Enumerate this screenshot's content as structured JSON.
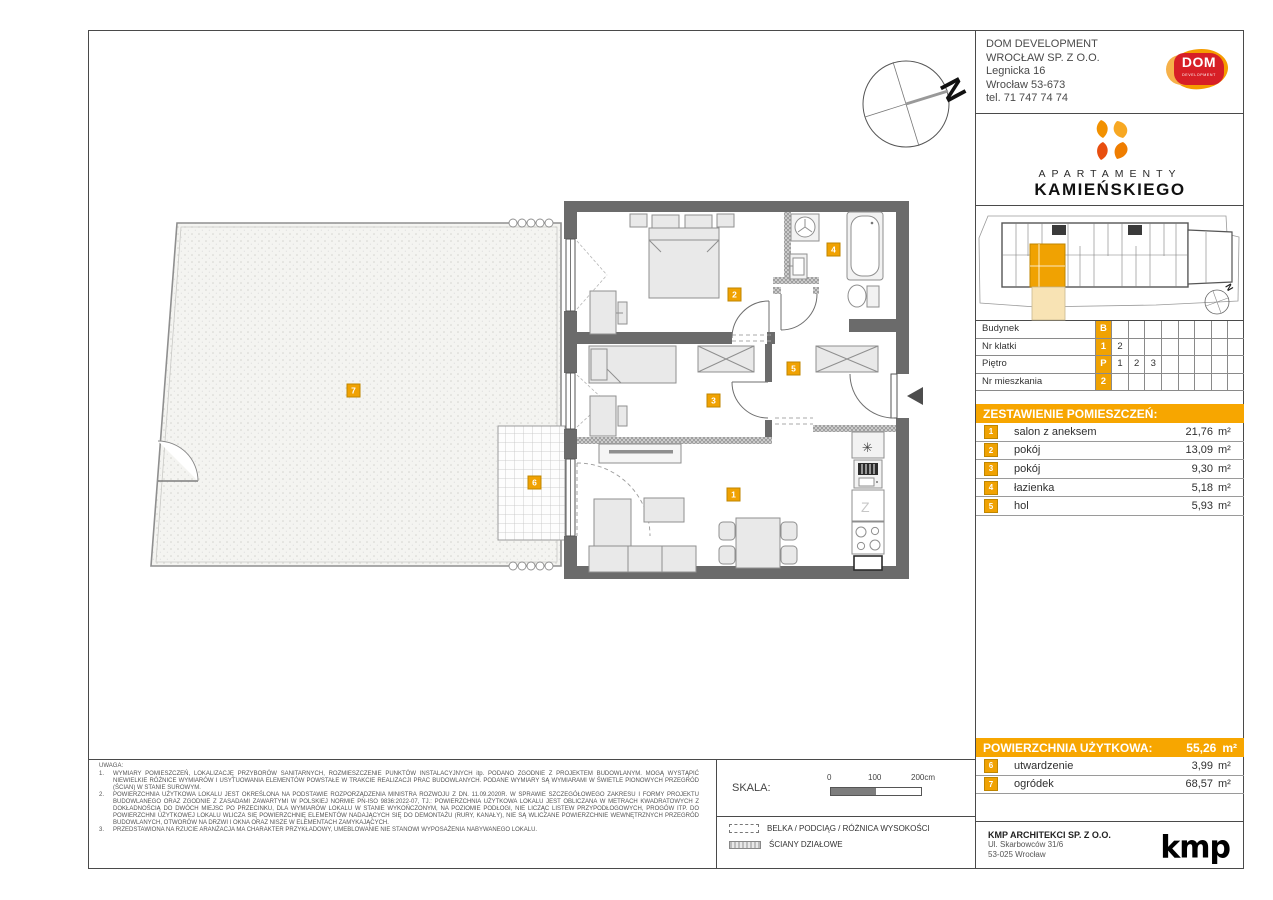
{
  "company": {
    "name_line1": "DOM DEVELOPMENT",
    "name_line2": "WROCŁAW SP. Z O.O.",
    "address_line1": "Legnicka 16",
    "address_line2": "Wrocław 53-673",
    "phone": "tel. 71 747 74 74",
    "logo_text": "DOM",
    "logo_subtext": "DEVELOPMENT"
  },
  "brand": {
    "line1": "APARTAMENTY",
    "line2": "KAMIEŃSKIEGO"
  },
  "compass": {
    "label": "N"
  },
  "site_compass": {
    "label": "N"
  },
  "unit_info": {
    "rows": [
      {
        "label": "Budynek",
        "highlight": "B",
        "cells": [
          "",
          "",
          "",
          "",
          "",
          "",
          "",
          ""
        ]
      },
      {
        "label": "Nr klatki",
        "highlight": "1",
        "cells": [
          "2",
          "",
          "",
          "",
          "",
          "",
          "",
          ""
        ]
      },
      {
        "label": "Piętro",
        "highlight": "P",
        "cells": [
          "1",
          "2",
          "3",
          "",
          "",
          "",
          "",
          ""
        ]
      },
      {
        "label": "Nr mieszkania",
        "highlight": "2",
        "cells": [
          "",
          "",
          "",
          "",
          "",
          "",
          "",
          ""
        ]
      }
    ]
  },
  "rooms": {
    "title": "ZESTAWIENIE POMIESZCZEŃ:",
    "items": [
      {
        "num": "1",
        "name": "salon z aneksem",
        "area": "21,76",
        "unit": "m²"
      },
      {
        "num": "2",
        "name": "pokój",
        "area": "13,09",
        "unit": "m²"
      },
      {
        "num": "3",
        "name": "pokój",
        "area": "9,30",
        "unit": "m²"
      },
      {
        "num": "4",
        "name": "łazienka",
        "area": "5,18",
        "unit": "m²"
      },
      {
        "num": "5",
        "name": "hol",
        "area": "5,93",
        "unit": "m²"
      }
    ]
  },
  "summary": {
    "title": "POWIERZCHNIA UŻYTKOWA:",
    "value": "55,26",
    "unit": "m²",
    "extras": [
      {
        "num": "6",
        "name": "utwardzenie",
        "area": "3,99",
        "unit": "m²"
      },
      {
        "num": "7",
        "name": "ogródek",
        "area": "68,57",
        "unit": "m²"
      }
    ]
  },
  "architect": {
    "name": "KMP ARCHITEKCI SP. Z O.O.",
    "address1": "Ul. Skarbowców 31/6",
    "address2": "53-025 Wrocław",
    "logo": "kmp"
  },
  "notes": {
    "heading": "UWAGA:",
    "items": [
      {
        "num": "1.",
        "text": "WYMIARY POMIESZCZEŃ, LOKALIZACJĘ PRZYBORÓW SANITARNYCH, ROZMIESZCZENIE PUNKTÓW INSTALACYJNYCH itp. PODANO ZGODNIE Z PROJEKTEM BUDOWLANYM. MOGĄ WYSTĄPIĆ NIEWIELKIE RÓŻNICE WYMIARÓW I USYTUOWANIA ELEMENTÓW POWSTAŁE W TRAKCIE REALIZACJI PRAC BUDOWLANYCH. PODANE WYMIARY SĄ WYMIARAMI W ŚWIETLE PIONOWYCH PRZEGRÓD (ŚCIAN) W STANIE SUROWYM."
      },
      {
        "num": "2.",
        "text": "POWIERZCHNIA UŻYTKOWA LOKALU JEST OKREŚLONA NA PODSTAWIE ROZPORZĄDZENIA MINISTRA ROZWOJU Z DN. 11.09.2020R. W SPRAWIE SZCZEGÓŁOWEGO ZAKRESU I FORMY PROJEKTU BUDOWLANEGO ORAZ ZGODNIE Z ZASADAMI ZAWARTYMI W POLSKIEJ NORMIE PN-ISO 9836:2022-07, TJ.: POWIERZCHNIA UŻYTKOWA LOKALU JEST OBLICZANA W METRACH KWADRATOWYCH Z DOKŁADNOŚCIĄ DO DWÓCH MIEJSC PO PRZECINKU, DLA WYMIARÓW LOKALU W STANIE WYKOŃCZONYM, NA POZIOMIE PODŁOGI, NIE LICZĄC LISTEW PRZYPODŁOGOWYCH, PROGÓW ITP. DO POWIERZCHNI UŻYTKOWEJ LOKALU WLICZA SIĘ POWIERZCHNIĘ ELEMENTÓW NADAJĄCYCH SIĘ DO DEMONTAŻU (RURY, KANAŁY), NIE SĄ WLICZANE POWIERZCHNIE WEWNĘTRZNYCH PRZEGRÓD BUDOWLANYCH, OTWORÓW NA DRZWI I OKNA ORAZ NISZE W ELEMENTACH ZAMYKAJĄCYCH."
      },
      {
        "num": "3.",
        "text": "PRZEDSTAWIONA NA RZUCIE ARANŻACJA MA CHARAKTER PRZYKŁADOWY, UMEBLOWANIE NIE STANOWI WYPOSAŻENIA NABYWANEGO LOKALU."
      }
    ]
  },
  "scale": {
    "label": "SKALA:",
    "tick0": "0",
    "tick100": "100",
    "tick200": "200cm"
  },
  "legend": {
    "beam_label": "BELKA / PODCIĄG / RÓŻNICA WYSOKOŚCI",
    "partition_label": "ŚCIANY DZIAŁOWE"
  },
  "plan": {
    "labels": [
      "1",
      "2",
      "3",
      "4",
      "5",
      "6",
      "7"
    ],
    "symbols": {
      "freezer": "✳",
      "counter": "Z"
    }
  },
  "colors": {
    "accent": "#F7A600",
    "label_fill": "#F0A202",
    "label_border": "#BF8600",
    "wall": "#6b6b6b"
  }
}
